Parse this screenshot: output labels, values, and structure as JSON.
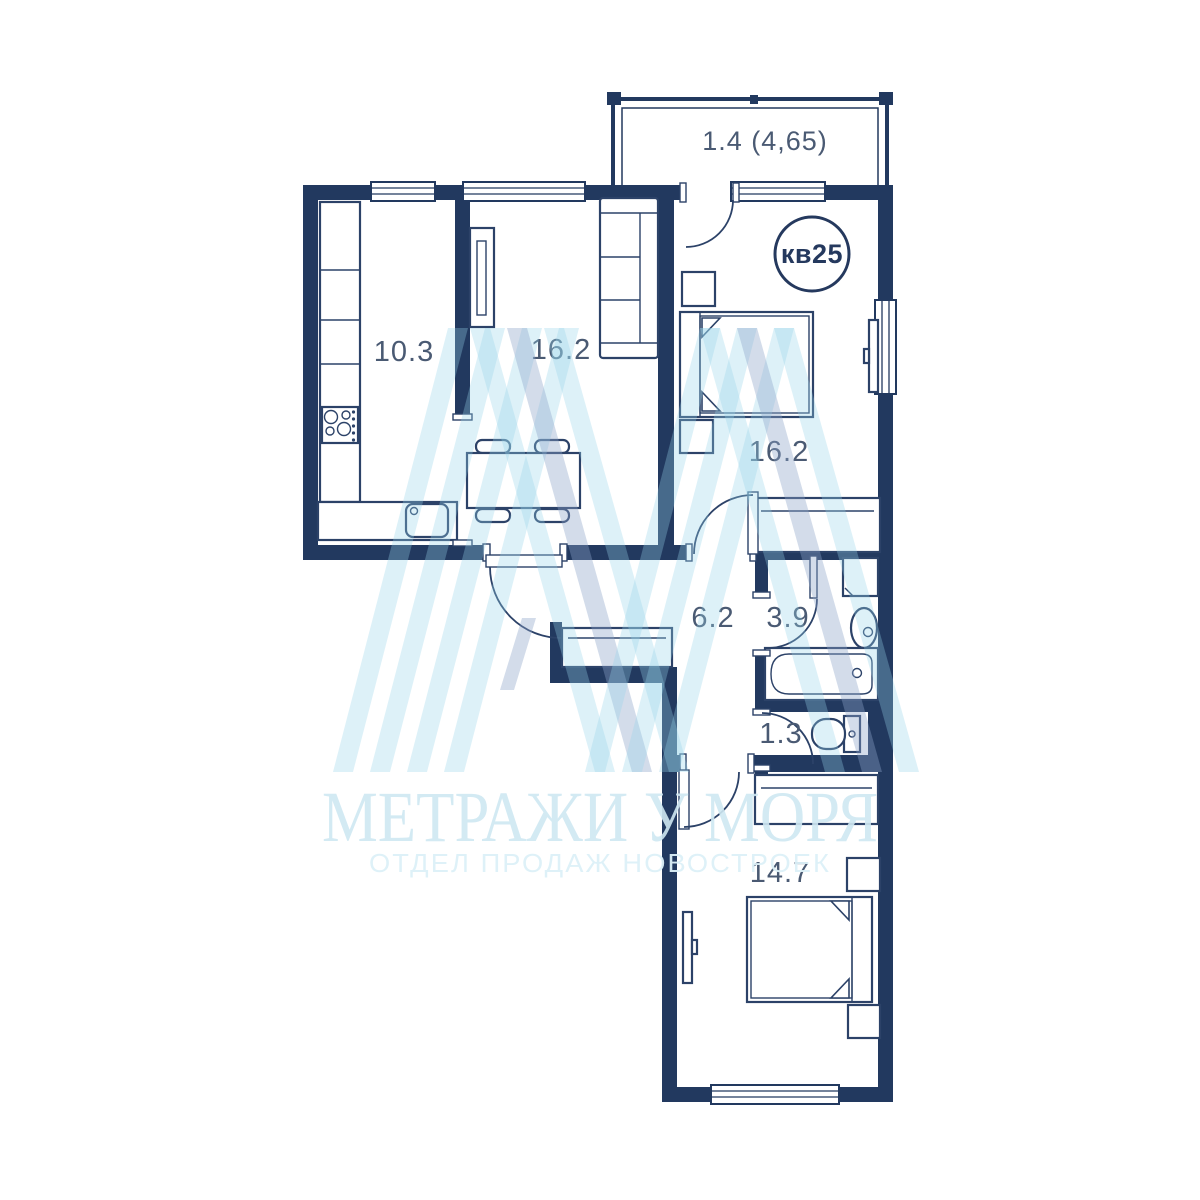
{
  "floorplan": {
    "badge_label": "кв25",
    "balcony": {
      "area": "1.4 (4,65)"
    },
    "rooms": {
      "kitchen": {
        "area": "10.3"
      },
      "living": {
        "area": "16.2"
      },
      "bedroom1": {
        "area": "16.2"
      },
      "hallway": {
        "area": "6.2"
      },
      "bathroom": {
        "area": "3.9"
      },
      "wc": {
        "area": "1.3"
      },
      "bedroom2": {
        "area": "14.7"
      }
    }
  },
  "watermark": {
    "title": "МЕТРАЖИ У МОРЯ",
    "subtitle": "ОТДЕЛ ПРОДАЖ НОВОСТРОЕК"
  },
  "colors": {
    "wall": "#22395f",
    "furniture_line": "#2c4268",
    "label": "#4a5a73",
    "watermark_text": "#cfe8f2",
    "watermark_stripe": "#94d3e8",
    "watermark_accent": "#8ca3c7"
  }
}
